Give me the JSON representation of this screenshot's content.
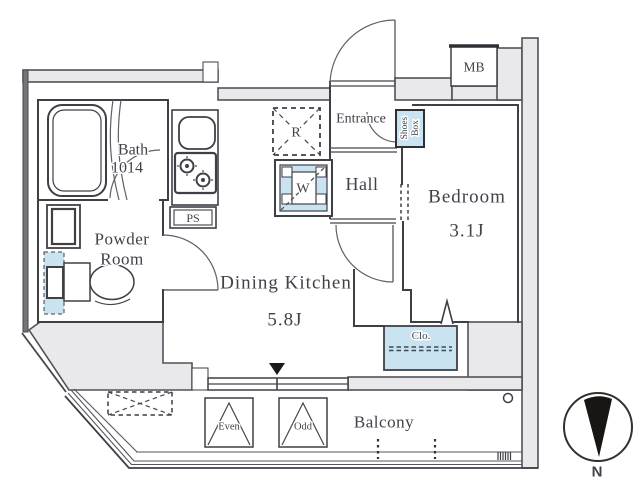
{
  "plan": {
    "rooms": {
      "bath": {
        "label": "Bath",
        "size": "1014"
      },
      "powder": {
        "line1": "Powder",
        "line2": "Room"
      },
      "dk": {
        "label": "Dining Kitchen",
        "size": "5.8J"
      },
      "entrance": {
        "label": "Entrance"
      },
      "hall": {
        "label": "Hall"
      },
      "bedroom": {
        "label": "Bedroom",
        "size": "3.1J"
      },
      "balcony": {
        "label": "Balcony"
      },
      "closet": {
        "label": "Clo."
      },
      "shoes_box": {
        "line1": "Shoes",
        "line2": "Box"
      },
      "meter_box": {
        "label": "MB"
      },
      "pipe_space": {
        "label": "PS"
      }
    },
    "fixtures": {
      "refrigerator": "R",
      "washer": "W"
    },
    "hatches": {
      "even": "Even",
      "odd": "Odd"
    },
    "compass": {
      "north": "N"
    },
    "colors": {
      "fixture_blue": "#c9e3f1",
      "wall_gray": "#e9e9ec",
      "text_color": "#41414a"
    }
  }
}
